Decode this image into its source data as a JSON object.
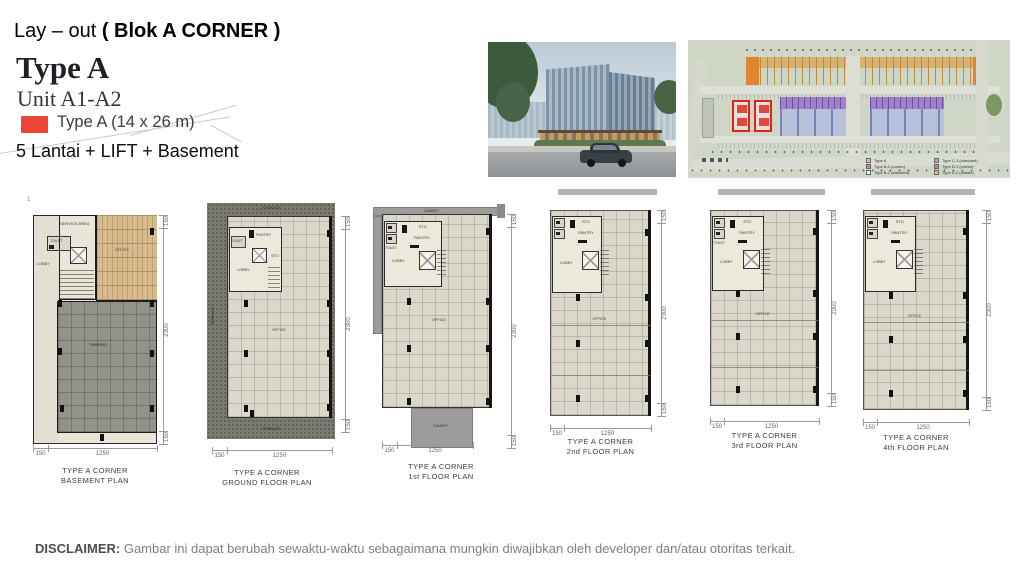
{
  "header": {
    "title_regular": "Lay – out ",
    "title_bold": "( Blok A CORNER )",
    "type_heading": "Type A",
    "unit_line": "Unit A1-A2",
    "swatch_color": "#ee4337",
    "swatch_label": "Type A  (14 x 26 m)",
    "spec_line": "5 Lantai + LIFT + Basement",
    "artifact_mark": "1"
  },
  "site_plan": {
    "highlight_color": "#e02317",
    "legend": [
      {
        "color": "#f2b3c0",
        "label": "Type A"
      },
      {
        "color": "#8f9cc0",
        "label": "Type B-1 (corner)"
      },
      {
        "color": "#f4f4f0",
        "label": "Type B-2 (standard)"
      },
      {
        "color": "#b89fd8",
        "label": "Type C-1 (standard)"
      },
      {
        "color": "#e0862e",
        "label": "Type D-1 (corner)"
      },
      {
        "color": "#f0c050",
        "label": "Type D-2 (middle)"
      }
    ]
  },
  "floor_plans": [
    {
      "id": "basement",
      "caption": [
        "TYPE A CORNER",
        "BASEMENT PLAN"
      ],
      "labels": {
        "service_area": "SERVICE AREA",
        "toilet": "TOILET",
        "lobby": "LOBBY",
        "office": "OFFICE",
        "parking": "PARKING"
      },
      "dims": {
        "side": [
          "150",
          "2300",
          "150"
        ],
        "bottom": [
          "150",
          "1250"
        ]
      }
    },
    {
      "id": "ground",
      "caption": [
        "TYPE A CORNER",
        "GROUND FLOOR PLAN"
      ],
      "labels": {
        "terrace_top": "TERRACE",
        "terrace_left": "TERRACE",
        "terrace_bottom": "TERRACE",
        "toilet": "TOILET",
        "pantry": "PANTRY",
        "sto": "STO",
        "lobby": "LOBBY",
        "office": "OFFICE"
      },
      "dims": {
        "side": [
          "150",
          "2300",
          "150"
        ],
        "bottom": [
          "150",
          "1250"
        ]
      }
    },
    {
      "id": "first",
      "caption": [
        "TYPE A CORNER",
        "1st FLOOR PLAN"
      ],
      "labels": {
        "canopy_top": "CANOPY",
        "canopy_bottom": "CANOPY",
        "toilet": "TOILET",
        "pantry": "PANTRY",
        "sto": "STO",
        "lobby": "LOBBY",
        "office": "OFFICE"
      },
      "dims": {
        "side": [
          "150",
          "2300",
          "150"
        ],
        "bottom": [
          "150",
          "1250"
        ]
      }
    },
    {
      "id": "second",
      "caption": [
        "TYPE A CORNER",
        "2nd FLOOR PLAN"
      ],
      "labels": {
        "pantry": "PANTRY",
        "sto": "STO",
        "lobby": "LOBBY",
        "office": "OFFICE"
      },
      "dims": {
        "side": [
          "150",
          "2300",
          "150"
        ],
        "bottom": [
          "150",
          "1250"
        ]
      }
    },
    {
      "id": "third",
      "caption": [
        "TYPE A CORNER",
        "3rd FLOOR PLAN"
      ],
      "labels": {
        "toilet": "TOILET",
        "pantry": "PANTRY",
        "sto": "STO",
        "lobby": "LOBBY",
        "office": "OFFICE"
      },
      "dims": {
        "side": [
          "150",
          "2300",
          "150"
        ],
        "bottom": [
          "150",
          "1250"
        ]
      }
    },
    {
      "id": "fourth",
      "caption": [
        "TYPE A CORNER",
        "4th FLOOR PLAN"
      ],
      "labels": {
        "pantry": "PANTRY",
        "sto": "STO",
        "lobby": "LOBBY",
        "office": "OFFICE"
      },
      "dims": {
        "side": [
          "150",
          "2300",
          "150"
        ],
        "bottom": [
          "150",
          "1250"
        ]
      }
    }
  ],
  "disclaimer": {
    "label": "DISCLAIMER:",
    "text": " Gambar ini dapat berubah sewaktu-waktu sebagaimana mungkin diwajibkan oleh developer dan/atau otoritas terkait."
  }
}
